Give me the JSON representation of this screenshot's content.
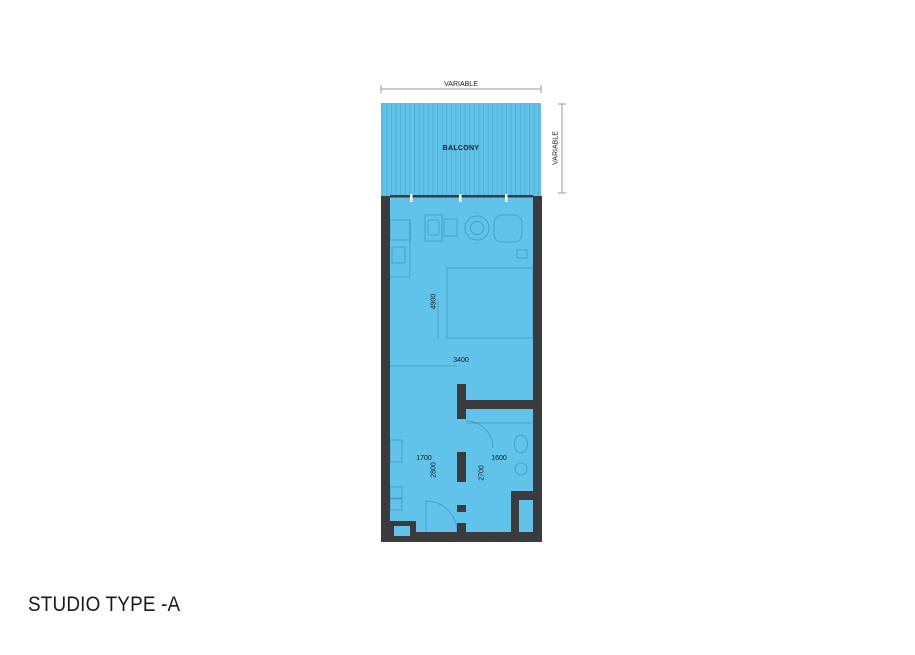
{
  "title": "STUDIO TYPE -A",
  "plan": {
    "balcony_label": "BALCONY",
    "dimensions": {
      "top": "VARIABLE",
      "right": "VARIABLE",
      "room_depth": "4900",
      "room_width": "3400",
      "entry_width": "1700",
      "entry_depth": "2800",
      "bath_width": "1600",
      "bath_depth": "2700"
    },
    "colors": {
      "floor": "#62C3EA",
      "hatch": "#4FAFD6",
      "wall": "#3B3B3D",
      "dim_line": "#9B9B9B",
      "text": "#1A1A1A"
    }
  }
}
